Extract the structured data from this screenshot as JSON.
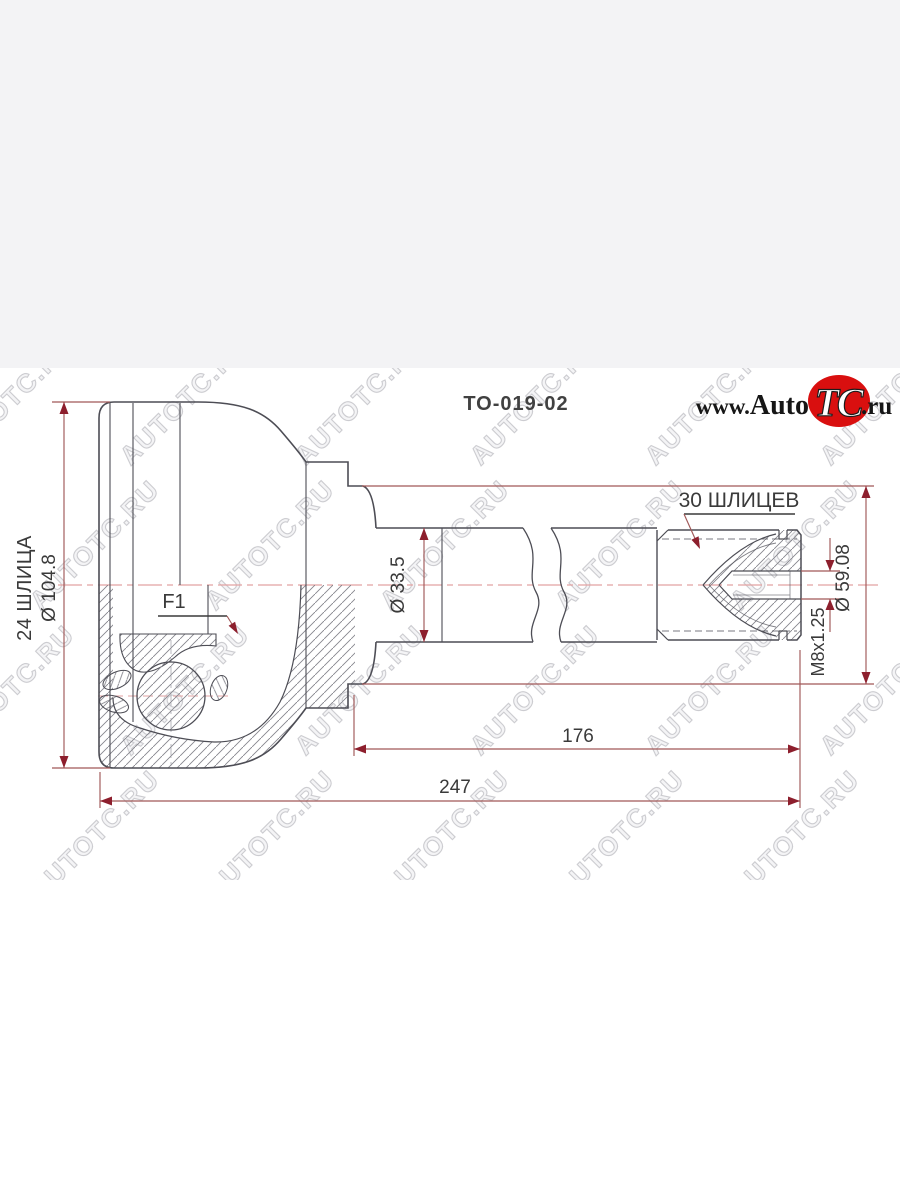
{
  "header": {
    "part_number": "TO-019-02"
  },
  "logo": {
    "www": "www.",
    "auto": "Auto",
    "tc": "TC",
    "ru": ".ru",
    "badge_color": "#d90f0f"
  },
  "watermark": {
    "text": "AUTOTC.RU"
  },
  "dimensions": {
    "spline_count_outer": "30 ШЛИЦЕВ",
    "spline_count_inner": "24 ШЛИЦА",
    "outer_diameter": "Ø 104.8",
    "shaft_diameter": "Ø 33.5",
    "step_diameter": "Ø 59.08",
    "thread_spec": "M8x1.25",
    "marking": "F1",
    "shaft_length": "176",
    "total_length": "247"
  },
  "colors": {
    "dimension_red": "#8d1f2d",
    "dimension_line": "#a05858",
    "outline_dark": "#4d4d55",
    "centerline_pink": "#e2a2a2",
    "label_text": "#3a3a3a",
    "top_band": "#f3f3f5",
    "logo_red": "#d90f0f"
  }
}
